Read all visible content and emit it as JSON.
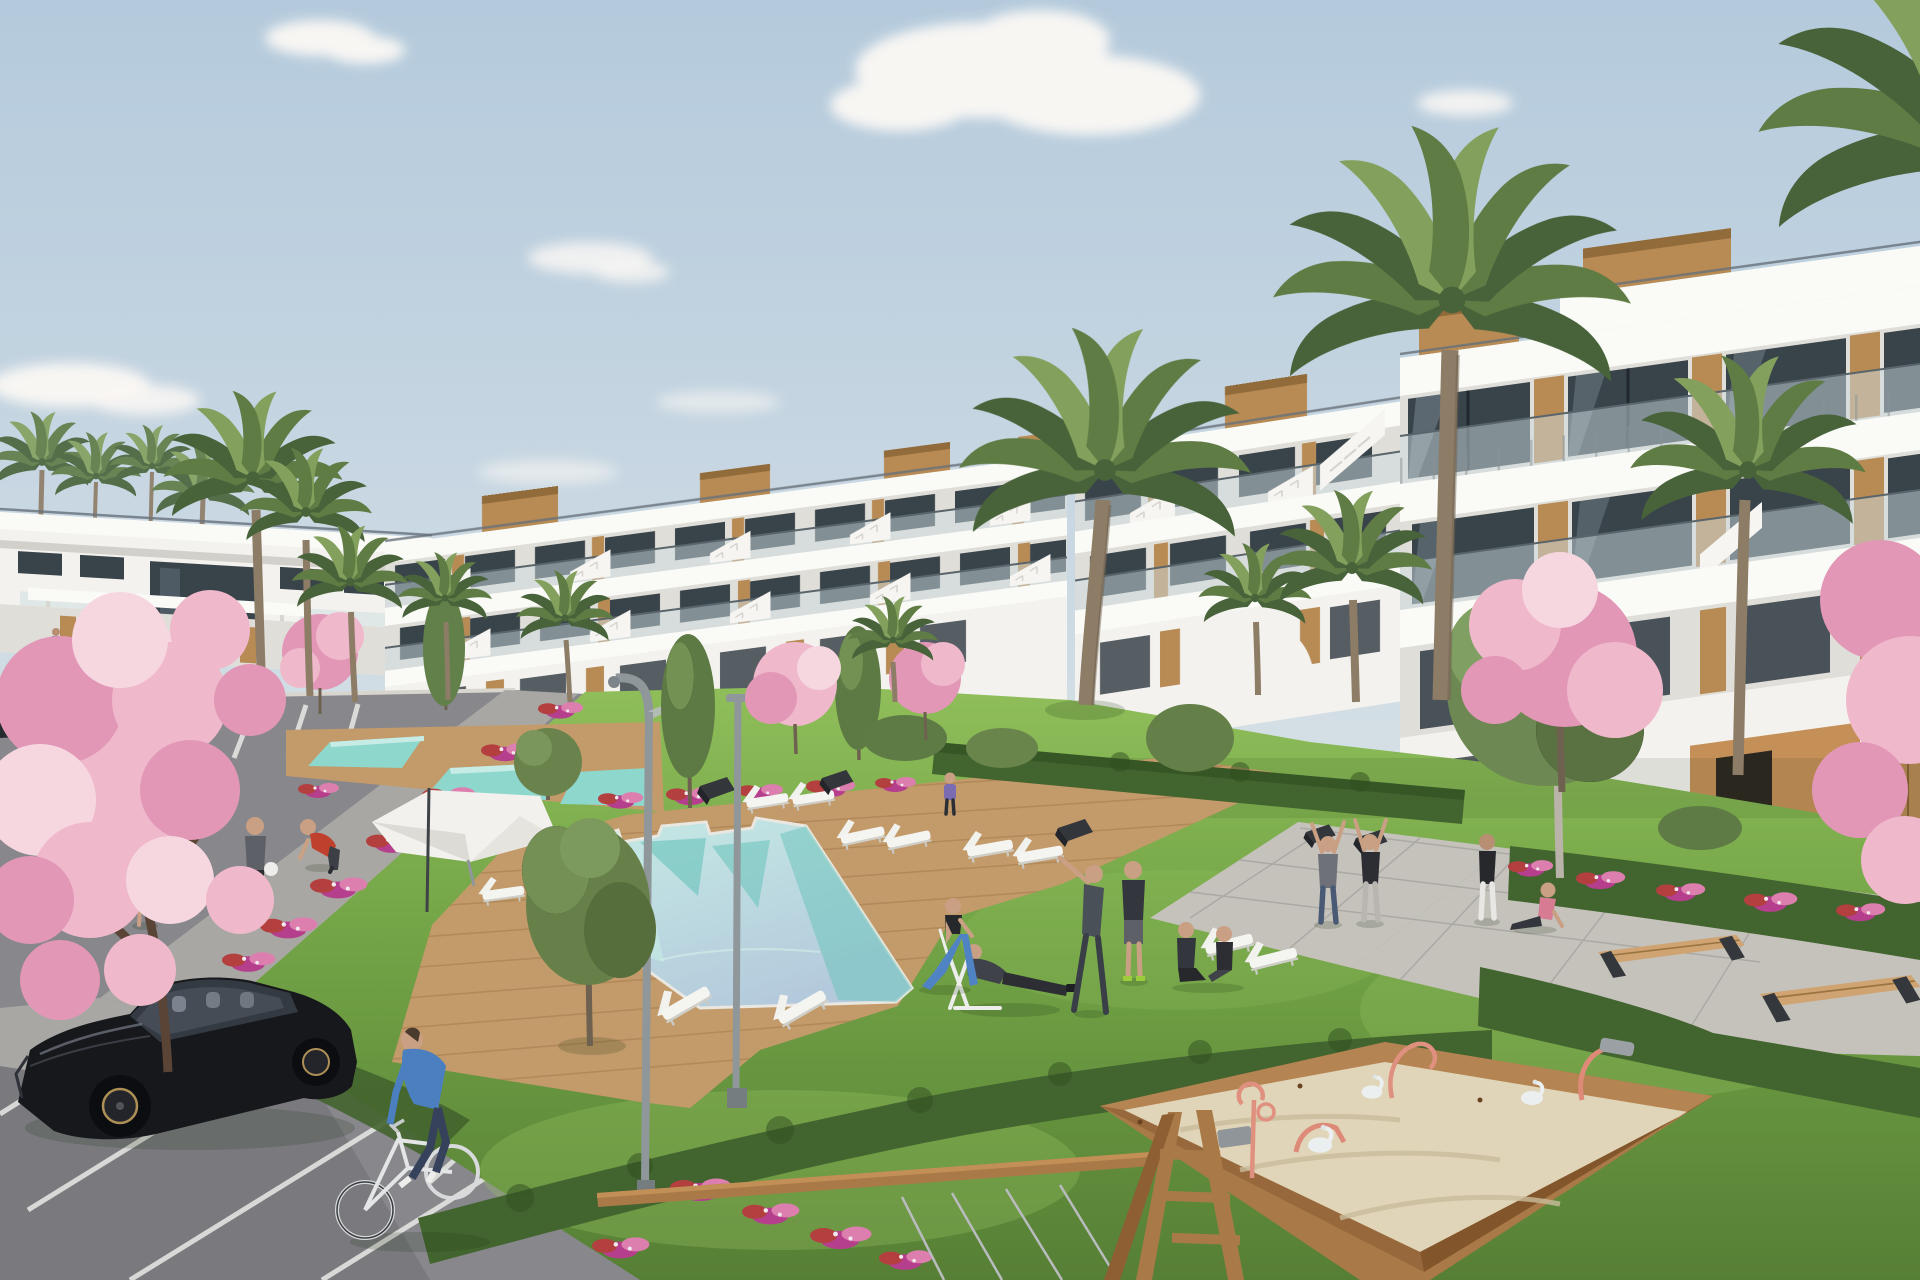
{
  "scene": {
    "type": "3d-architectural-render",
    "setting": "mediterranean-resort-apartment-complex",
    "description": "Photorealistic architectural rendering of a white terraced apartment complex with wood cladding and glass balustrades, palm trees and cherry blossoms, turquoise angular swimming pools with wooden decks, residents walking, cycling and exercising on lawns, a parking lot with a black hatchback and sedans, curved street lamps, and a children's playground with a wooden sandbox and swing frame under a clear blue sky.",
    "time_of_day": "day",
    "weather": "clear with scattered clouds"
  },
  "colors": {
    "sky_top": "#b4cadc",
    "sky_mid": "#cbd9e3",
    "sky_low": "#e2e7e8",
    "sky_horizon": "#eeede9",
    "cloud": "#f8f6f3",
    "building_white": "#f3f2ee",
    "fascia": "#fafaf7",
    "wall_recess": "#e0ded8",
    "building_shade": "#d2d0ca",
    "glass_dark": "#39434a",
    "glass_mid": "#5d6d76",
    "glass_light": "#9db0ba",
    "balustrade": "#ccdbe0",
    "rail_dark": "#5a646b",
    "roof_rail": "#66717a",
    "wood": "#b88a54",
    "wood_dark": "#926b3b",
    "wood_light": "#cfa472",
    "ochre_wall": "#c49058",
    "grass": "#74a547",
    "grass_light": "#8fbe5a",
    "grass_dark": "#567f35",
    "hedge": "#42642e",
    "hedge_dark": "#2f4d20",
    "flower_magenta": "#b53e8d",
    "flower_pink": "#dd7fae",
    "flower_red": "#b43f3f",
    "blossom": "#efb9cb",
    "blossom_deep": "#e297b6",
    "blossom_pale": "#f6d7e0",
    "palm": "#5f7c45",
    "palm_dark": "#48633a",
    "palm_light": "#83a05c",
    "trunk": "#8d7c66",
    "trunk_dark": "#6f6150",
    "pool": "#8ed7cd",
    "pool_light": "#c6ece5",
    "pool_deep": "#5ec0b6",
    "deck": "#c39a6a",
    "deck_dark": "#a67e4e",
    "path_gray": "#a9a7a3",
    "paver": "#c5c2bc",
    "asphalt": "#87878c",
    "asphalt_dark": "#6e6e73",
    "line_white": "#e9e9e5",
    "curb": "#d8d5cf",
    "sand": "#e0d5b8",
    "sand_shade": "#c9bc9b",
    "frame_wood": "#a97a48",
    "frame_wood_dark": "#82552b",
    "metal_gray": "#b9bcbe",
    "pole_gray": "#8f979b",
    "car_black": "#17181c",
    "car_gloss": "#454c56",
    "car_sedan": "#262a31",
    "skin": "#c9a084",
    "blue_shirt": "#4b7fc0",
    "navy": "#36415c",
    "teal_shirt": "#52aca1",
    "pink_shirt": "#d77b93",
    "red_shirt": "#c0402e",
    "gray_shirt": "#5d6066",
    "dark_outfit": "#2c2e33",
    "white_cloth": "#edeeec",
    "lime": "#9ccb3c"
  },
  "objects": {
    "buildings": {
      "wings": 4,
      "style": "white terraced apartments, wood cladding, glass balustrades, rooftop stair bulkheads",
      "rooftop_wood_boxes": 7
    },
    "vegetation": {
      "palm_trees": 14,
      "cherry_blossom_trees": 7,
      "columnar_trees": 3,
      "olive_trees": 2,
      "round_trees": 1,
      "hedge_rows": 5,
      "flower_beds": 26
    },
    "water": {
      "main_pool": 1,
      "secondary_pools": 3
    },
    "furniture": {
      "sun_loungers": 12,
      "parasols": 1,
      "benches": 7,
      "street_lamps": 3,
      "garden_arch": 1
    },
    "people": {
      "total": 18,
      "activities": [
        "walking",
        "cycling",
        "stretching",
        "yoga",
        "jogging",
        "sitting",
        "sunbathing",
        "gardening"
      ]
    },
    "vehicles": {
      "black_hatchback": 1,
      "parked_sedans": 2,
      "bicycle": 1
    },
    "playground": {
      "sandbox": 1,
      "swing_frame": 1,
      "sand_toys": 7
    }
  }
}
